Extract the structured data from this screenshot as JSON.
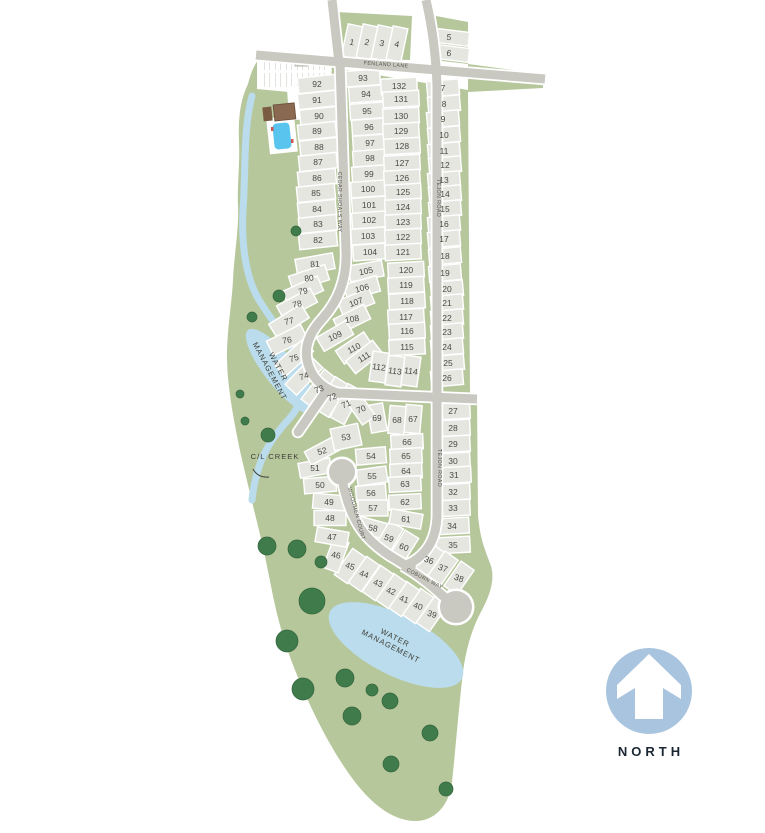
{
  "map": {
    "colors": {
      "land": "#b7c79c",
      "lot_fill": "#e6e6e1",
      "lot_stroke": "#ffffff",
      "road": "#c9c9c1",
      "water": "#badcec",
      "tree": "#3f7b4b",
      "pool": "#59c5ee",
      "clubhouse": "#8a6950",
      "north_circle": "#a9c4de"
    },
    "streets": [
      {
        "name": "FENLAND LANE",
        "x": 386,
        "y": 66,
        "rot": 4
      },
      {
        "name": "CEDAR SHOALS WAY",
        "x": 338,
        "y": 202,
        "rot": 90
      },
      {
        "name": "TEJON ROAD",
        "x": 437,
        "y": 198,
        "rot": 90
      },
      {
        "name": "TEJON ROAD",
        "x": 438,
        "y": 468,
        "rot": 90
      },
      {
        "name": "WOODMEN COURT",
        "x": 355,
        "y": 514,
        "rot": 75
      },
      {
        "name": "COBURN WAY",
        "x": 424,
        "y": 580,
        "rot": 27
      }
    ],
    "water_labels": [
      {
        "lines": [
          "WATER",
          "MANAGEMENT"
        ],
        "x": 276,
        "y": 368,
        "rot": 62
      },
      {
        "lines": [
          "WATER",
          "MANAGEMENT"
        ],
        "x": 394,
        "y": 640,
        "rot": 27
      }
    ],
    "creek_label": {
      "text": "C/L CREEK",
      "x": 275,
      "y": 459
    },
    "north": {
      "label": "NORTH"
    },
    "lot_groups": [
      {
        "w": 15,
        "h": 34,
        "r": 12,
        "tr": 12,
        "lots": [
          [
            1,
            352,
            42
          ],
          [
            2,
            367,
            42
          ],
          [
            3,
            382,
            43
          ],
          [
            4,
            397,
            44
          ]
        ]
      },
      {
        "w": 40,
        "h": 14,
        "r": 7,
        "tr": 7,
        "lots": [
          [
            5,
            449,
            37
          ],
          [
            6,
            449,
            53
          ]
        ]
      },
      {
        "w": 38,
        "h": 15.5,
        "r": -6,
        "lots": [
          [
            92,
            317,
            84
          ],
          [
            91,
            317,
            100
          ],
          [
            90,
            319,
            116
          ],
          [
            89,
            317,
            131
          ],
          [
            88,
            319,
            147
          ],
          [
            87,
            318,
            162
          ],
          [
            86,
            317,
            178
          ],
          [
            85,
            316,
            193
          ],
          [
            84,
            317,
            209
          ],
          [
            83,
            318,
            224
          ],
          [
            82,
            318,
            240
          ]
        ]
      },
      {
        "w": 38,
        "h": 16,
        "lots": [
          [
            81,
            315,
            264,
            -10,
            -5
          ],
          [
            80,
            309,
            278,
            -18,
            -8
          ],
          [
            79,
            303,
            291,
            -24,
            -10
          ],
          [
            78,
            297,
            304,
            -28,
            -12
          ],
          [
            77,
            289,
            321,
            -32,
            -14
          ],
          [
            76,
            287,
            340,
            -26,
            -10
          ],
          [
            75,
            294,
            358,
            -42,
            -18
          ],
          [
            74,
            304,
            376,
            -46,
            -18
          ],
          [
            73,
            319,
            389,
            -52,
            -20
          ],
          [
            72,
            332,
            397,
            -58,
            -22
          ],
          [
            71,
            346,
            404,
            -62,
            -24
          ]
        ]
      },
      {
        "w": 34,
        "h": 15.7,
        "r": -4,
        "lots": [
          [
            93,
            363,
            78
          ],
          [
            94,
            366,
            94
          ],
          [
            95,
            367,
            111
          ],
          [
            96,
            369,
            127
          ],
          [
            97,
            370,
            143
          ],
          [
            98,
            370,
            158
          ],
          [
            99,
            369,
            174
          ],
          [
            100,
            368,
            189
          ],
          [
            101,
            369,
            205
          ],
          [
            102,
            369,
            220
          ],
          [
            103,
            368,
            236
          ],
          [
            104,
            370,
            252
          ]
        ]
      },
      {
        "w": 34,
        "h": 16,
        "lots": [
          [
            105,
            366,
            271,
            -10,
            -12
          ],
          [
            106,
            362,
            288,
            -16,
            -16
          ],
          [
            107,
            356,
            302,
            -22,
            -20
          ],
          [
            108,
            352,
            319,
            -26,
            -10
          ],
          [
            109,
            335,
            336,
            -30,
            -25
          ],
          [
            110,
            354,
            348,
            -34,
            -28
          ],
          [
            111,
            364,
            357,
            -38,
            -32
          ]
        ]
      },
      {
        "w": 16,
        "h": 30,
        "r": 8,
        "tr": 8,
        "lots": [
          [
            112,
            379,
            367
          ],
          [
            113,
            395,
            371
          ],
          [
            114,
            411,
            371
          ]
        ]
      },
      {
        "w": 36,
        "h": 15.6,
        "r": -3,
        "lots": [
          [
            132,
            399,
            86
          ],
          [
            131,
            401,
            99
          ],
          [
            130,
            401,
            116
          ],
          [
            129,
            401,
            131
          ],
          [
            128,
            402,
            146
          ],
          [
            127,
            402,
            163
          ],
          [
            126,
            402,
            178
          ],
          [
            125,
            403,
            192
          ],
          [
            124,
            403,
            207
          ],
          [
            123,
            403,
            222
          ],
          [
            122,
            403,
            237
          ],
          [
            121,
            403,
            252
          ]
        ]
      },
      {
        "w": 36,
        "h": 15.6,
        "r": -3,
        "lots": [
          [
            120,
            406,
            270
          ],
          [
            119,
            406,
            285
          ],
          [
            118,
            407,
            301
          ],
          [
            117,
            406,
            317
          ],
          [
            116,
            407,
            331
          ],
          [
            115,
            407,
            347
          ]
        ]
      },
      {
        "w": 32,
        "h": 15.7,
        "r": -5,
        "lots": [
          [
            7,
            443,
            88
          ],
          [
            8,
            444,
            104
          ],
          [
            9,
            443,
            119
          ],
          [
            10,
            444,
            135
          ],
          [
            11,
            444,
            151
          ],
          [
            12,
            445,
            165
          ],
          [
            13,
            444,
            180
          ],
          [
            14,
            445,
            194
          ],
          [
            15,
            445,
            209
          ],
          [
            16,
            444,
            224
          ],
          [
            17,
            444,
            239
          ]
        ]
      },
      {
        "w": 32,
        "h": 15.7,
        "r": -5,
        "lots": [
          [
            18,
            445,
            256
          ],
          [
            19,
            445,
            273
          ],
          [
            20,
            447,
            289
          ],
          [
            21,
            447,
            303
          ],
          [
            22,
            447,
            318
          ],
          [
            23,
            447,
            332
          ],
          [
            24,
            447,
            347
          ],
          [
            25,
            448,
            363
          ],
          [
            26,
            447,
            378
          ]
        ]
      },
      {
        "w": 34,
        "h": 16,
        "r": -3,
        "lots": [
          [
            27,
            453,
            411
          ],
          [
            28,
            453,
            428
          ],
          [
            29,
            453,
            444
          ],
          [
            30,
            453,
            461
          ],
          [
            31,
            454,
            475
          ],
          [
            32,
            453,
            492
          ],
          [
            33,
            453,
            508
          ],
          [
            34,
            452,
            526
          ],
          [
            35,
            453,
            545
          ]
        ]
      },
      {
        "w": 16,
        "h": 30,
        "r": 35,
        "tr": 20,
        "lots": [
          [
            36,
            429,
            560
          ],
          [
            37,
            443,
            568
          ],
          [
            38,
            459,
            578
          ]
        ]
      },
      {
        "w": 16,
        "h": 32,
        "r": 35,
        "tr": 18,
        "lots": [
          [
            39,
            432,
            614
          ],
          [
            40,
            418,
            606
          ],
          [
            41,
            404,
            599
          ],
          [
            42,
            391,
            591
          ],
          [
            43,
            378,
            583
          ],
          [
            44,
            364,
            574
          ],
          [
            45,
            350,
            566
          ],
          [
            46,
            336,
            555,
            20,
            10
          ]
        ]
      },
      {
        "w": 32,
        "h": 15,
        "r": 0,
        "lots": [
          [
            47,
            332,
            537,
            10
          ],
          [
            48,
            330,
            518
          ],
          [
            49,
            329,
            502,
            5
          ],
          [
            50,
            320,
            485,
            -5
          ],
          [
            51,
            315,
            468,
            -10
          ],
          [
            52,
            322,
            451,
            -28,
            -15
          ]
        ]
      },
      {
        "w": 28,
        "h": 22,
        "r": -12,
        "tr": -8,
        "lots": [
          [
            53,
            346,
            437
          ]
        ]
      },
      {
        "w": 30,
        "h": 16,
        "r": -5,
        "lots": [
          [
            54,
            371,
            456
          ],
          [
            55,
            372,
            476,
            -8
          ],
          [
            56,
            371,
            493
          ],
          [
            57,
            373,
            508,
            0
          ],
          [
            58,
            373,
            528,
            15,
            10
          ]
        ]
      },
      {
        "w": 16,
        "h": 30,
        "r": 30,
        "tr": 20,
        "lots": [
          [
            59,
            389,
            538
          ],
          [
            60,
            404,
            547,
            32
          ]
        ]
      },
      {
        "w": 32,
        "h": 15,
        "r": -3,
        "lots": [
          [
            66,
            407,
            442
          ],
          [
            65,
            406,
            456
          ],
          [
            64,
            406,
            471
          ],
          [
            63,
            405,
            484
          ],
          [
            62,
            405,
            502
          ],
          [
            61,
            406,
            519,
            10,
            6
          ]
        ]
      },
      {
        "w": 16,
        "h": 28,
        "r": 5,
        "tr": 0,
        "lots": [
          [
            67,
            413,
            419
          ],
          [
            68,
            397,
            420
          ],
          [
            69,
            377,
            418,
            -10
          ],
          [
            70,
            361,
            409,
            -35,
            -20
          ]
        ]
      }
    ]
  }
}
